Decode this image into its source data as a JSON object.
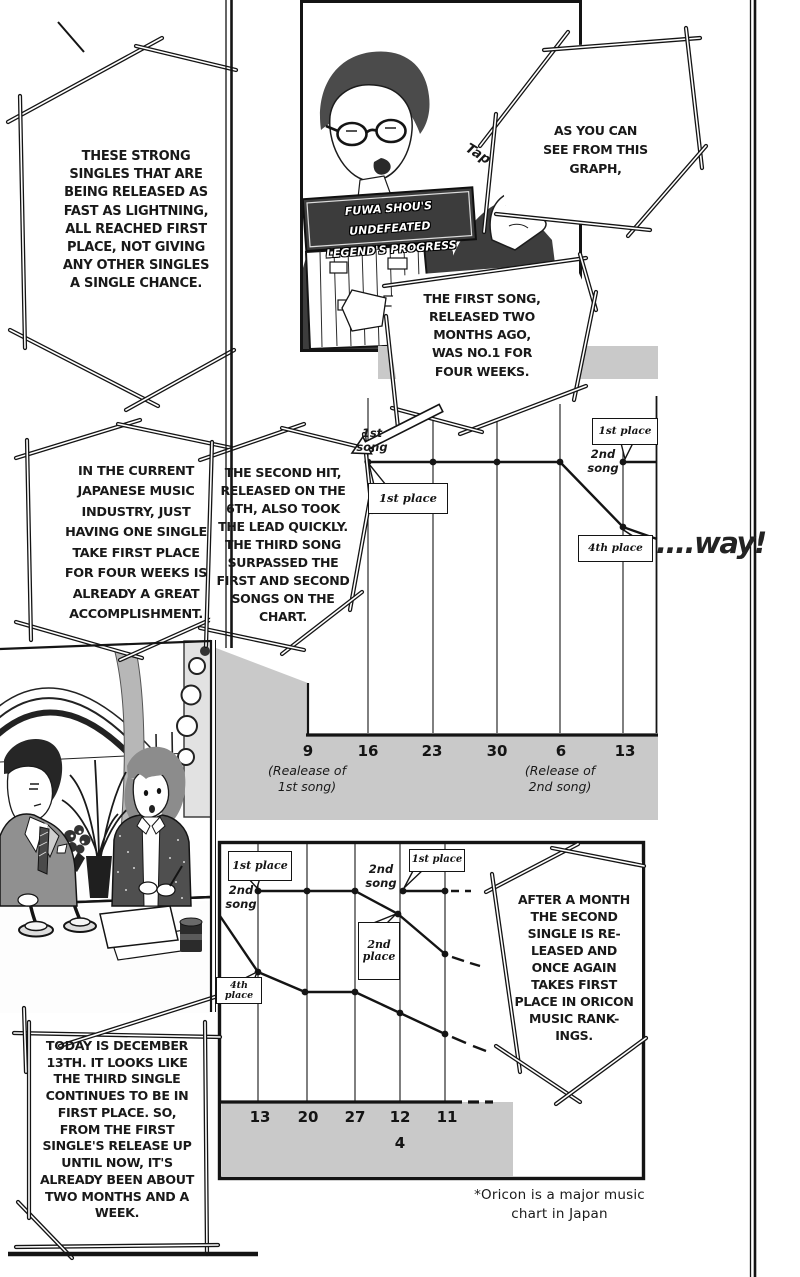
{
  "page": {
    "footnote": "*Oricon is a major music\nchart in Japan",
    "sfx_tap": "Tap",
    "sfx_way": "....way!"
  },
  "panel_sign": {
    "text": "FUWA SHOU'S UNDEFEATED\nLEGEND'S PROGRESS"
  },
  "bubbles": {
    "strong_singles": "THESE STRONG\nSINGLES THAT ARE\nBEING RELEASED AS\nFAST AS LIGHTNING,\nALL REACHED FIRST\nPLACE, NOT GIVING\nANY OTHER SINGLES\nA SINGLE CHANCE.",
    "as_you_can_see": "AS YOU CAN\nSEE FROM THIS\nGRAPH,",
    "first_song": "THE FIRST SONG,\nRELEASED TWO\nMONTHS AGO,\nWAS NO.1 FOR\nFOUR WEEKS.",
    "industry": "IN THE CURRENT\nJAPANESE MUSIC\nINDUSTRY, JUST\nHAVING ONE SINGLE\nTAKE FIRST PLACE\nFOR FOUR WEEKS IS\nALREADY A GREAT\nACCOMPLISHMENT.",
    "second_hit": "THE SECOND HIT,\nRELEASED ON THE\n6TH, ALSO TOOK\nTHE LEAD QUICKLY.\nTHE THIRD SONG\nSURPASSED THE\nFIRST AND SECOND\nSONGS ON THE\nCHART.",
    "after_a_month": "AFTER A MONTH\nTHE SECOND\nSINGLE IS RE-\nLEASED AND\nONCE AGAIN\nTAKES FIRST\nPLACE IN ORICON\nMUSIC RANK-\nINGS.",
    "today": "TODAY IS DECEMBER\n13TH. IT LOOKS LIKE\nTHE THIRD SINGLE\nCONTINUES TO BE IN\nFIRST PLACE. SO,\nFROM THE FIRST\nSINGLE'S RELEASE UP\nUNTIL NOW, IT'S\nALREADY BEEN ABOUT\nTWO MONTHS AND A\nWEEK."
  },
  "chart_data": [
    {
      "id": "top-chart-oricon-weeks",
      "type": "line",
      "x_ticks": [
        "9",
        "16",
        "23",
        "30",
        "6",
        "13"
      ],
      "x_annotations": [
        "(Realease of\n1st song)",
        "(Release of\n2nd song)"
      ],
      "y_axis": "Oricon chart rank (1st place at top, axis unlabeled)",
      "grid": true,
      "series": [
        {
          "name": "1st song",
          "hand_label": "1st\nsong",
          "points": [
            {
              "x": "16",
              "rank": "1st place"
            },
            {
              "x": "23",
              "rank": "1st place"
            },
            {
              "x": "30",
              "rank": "1st place"
            },
            {
              "x": "6",
              "rank": "1st place"
            },
            {
              "x": "13",
              "rank": "4th place"
            }
          ],
          "continues_dashed": false
        },
        {
          "name": "2nd song",
          "hand_label": "2nd\nsong",
          "points": [
            {
              "x": "13",
              "rank": "1st place"
            }
          ],
          "continues_dashed": false
        }
      ],
      "callouts": {
        "c1": "1st place",
        "c2": "1st place",
        "c3": "4th place"
      }
    },
    {
      "id": "bottom-chart-oricon-weeks",
      "type": "line",
      "x_ticks": [
        "13",
        "20",
        "27",
        "12",
        "11"
      ],
      "x_sub_label": "4",
      "y_axis": "Oricon chart rank (1st place at top, axis unlabeled)",
      "grid": true,
      "series": [
        {
          "name": "1st song (continuing fall)",
          "points": [
            {
              "x": "13",
              "rank": "4th place"
            },
            {
              "x": "20",
              "rank": null
            },
            {
              "x": "27",
              "rank": null
            },
            {
              "x": "12",
              "rank": null
            },
            {
              "x": "11",
              "rank": null
            }
          ],
          "continues_dashed": true
        },
        {
          "name": "2nd song",
          "hand_label": "2nd\nsong",
          "points": [
            {
              "x": "13",
              "rank": "1st place"
            },
            {
              "x": "20",
              "rank": "1st place"
            },
            {
              "x": "27",
              "rank": "1st place"
            },
            {
              "x": "12",
              "rank": "2nd place"
            },
            {
              "x": "11",
              "rank": null
            }
          ],
          "continues_dashed": true
        },
        {
          "name": "2nd song (new release at 1st place)",
          "hand_label": "2nd\nsong",
          "points": [
            {
              "x": "12",
              "rank": "1st place"
            },
            {
              "x": "11",
              "rank": "1st place"
            }
          ],
          "continues_dashed": true
        }
      ],
      "callouts": {
        "c1": "1st place",
        "c2": "1st place",
        "c3": "2nd place",
        "c4": "4th place"
      }
    }
  ]
}
